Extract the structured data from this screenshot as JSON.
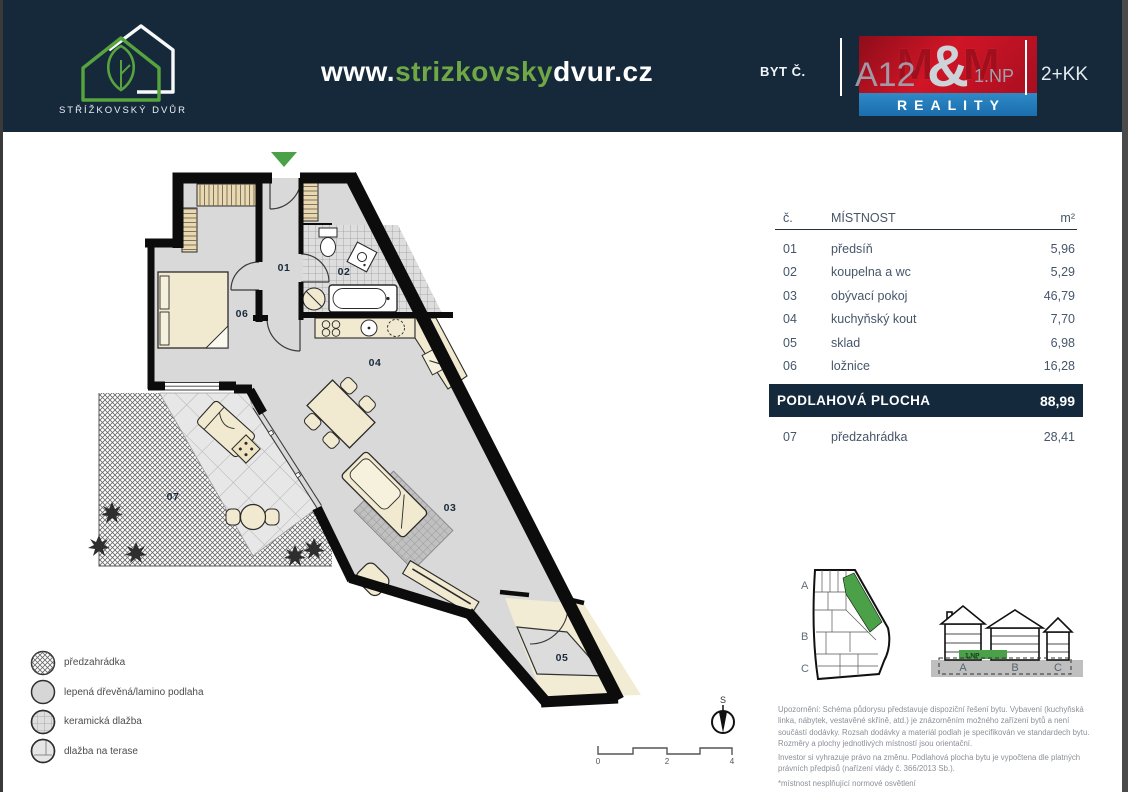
{
  "header": {
    "logo_caption": "STŘÍŽKOVSKÝ DVŮR",
    "website": {
      "prefix": "www.",
      "highlight": "strizkovsky",
      "suffix": "dvur.cz"
    },
    "byt_label": "BYT Č.",
    "unit_number": "A12",
    "unit_floor": "1.NP",
    "unit_layout": "2+KK",
    "mm_logo": {
      "m1": "M",
      "amp": "&",
      "m2": "M",
      "reality": "REALITY"
    }
  },
  "table": {
    "columns": {
      "num": "č.",
      "name": "MÍSTNOST",
      "area": "m²"
    },
    "rows": [
      {
        "num": "01",
        "name": "předsíň",
        "area": "5,96"
      },
      {
        "num": "02",
        "name": "koupelna a wc",
        "area": "5,29"
      },
      {
        "num": "03",
        "name": "obývací pokoj",
        "area": "46,79"
      },
      {
        "num": "04",
        "name": "kuchyňský kout",
        "area": "7,70"
      },
      {
        "num": "05",
        "name": "sklad",
        "area": "6,98"
      },
      {
        "num": "06",
        "name": "ložnice",
        "area": "16,28"
      },
      {
        "num": "07",
        "name": "předzahrádka",
        "area": "28,41"
      }
    ],
    "total": {
      "label": "PODLAHOVÁ PLOCHA",
      "value": "88,99"
    }
  },
  "plan": {
    "room_labels": [
      {
        "id": "01",
        "room": "předsíň"
      },
      {
        "id": "02",
        "room": "koupelna a wc"
      },
      {
        "id": "03",
        "room": "obývací pokoj"
      },
      {
        "id": "04",
        "room": "kuchyňský kout"
      },
      {
        "id": "05",
        "room": "sklad"
      },
      {
        "id": "06",
        "room": "ložnice"
      },
      {
        "id": "07",
        "room": "předzahrádka"
      }
    ],
    "north_label": "S",
    "scale_ticks": [
      "0",
      "2",
      "4"
    ]
  },
  "legend": {
    "items": [
      {
        "label": "předzahrádka",
        "swatch": "crosshatch"
      },
      {
        "label": "lepená dřevěná/lamino podlaha",
        "swatch": "plain"
      },
      {
        "label": "keramická dlažba",
        "swatch": "fine-grid"
      },
      {
        "label": "dlažba na terase",
        "swatch": "large-tile"
      }
    ]
  },
  "diagrams": {
    "site_plan_labels": {
      "a": "A",
      "b": "B",
      "c": "C"
    },
    "elevation_labels": {
      "a": "A",
      "b": "B",
      "c": "C",
      "level": "1.NP"
    }
  },
  "disclaimer": {
    "paragraph1": "Upozornění: Schéma půdorysu představuje dispoziční řešení bytu. Vybavení (kuchyňská linka, nábytek, vestavěné skříně, atd.) je znázorněním možného zařízení bytů a není součástí dodávky. Rozsah dodávky a materiál podlah je specifikován ve standardech bytu. Rozměry a plochy jednotlivých místností jsou orientační.",
    "paragraph2": "Investor si vyhrazuje právo na změnu. Podlahová plocha bytu je vypočtena dle platných právních předpisů (nařízení vlády č. 366/2013 Sb.).",
    "note": "*místnost nesplňující normové osvětlení"
  },
  "colors": {
    "navy": "#16293b",
    "accent_green": "#57a33e",
    "mm_red": "#c01022",
    "mm_blue": "#1f7bb8",
    "floor_gray": "#d9d9d9",
    "furniture_beige": "#f1ead0"
  }
}
